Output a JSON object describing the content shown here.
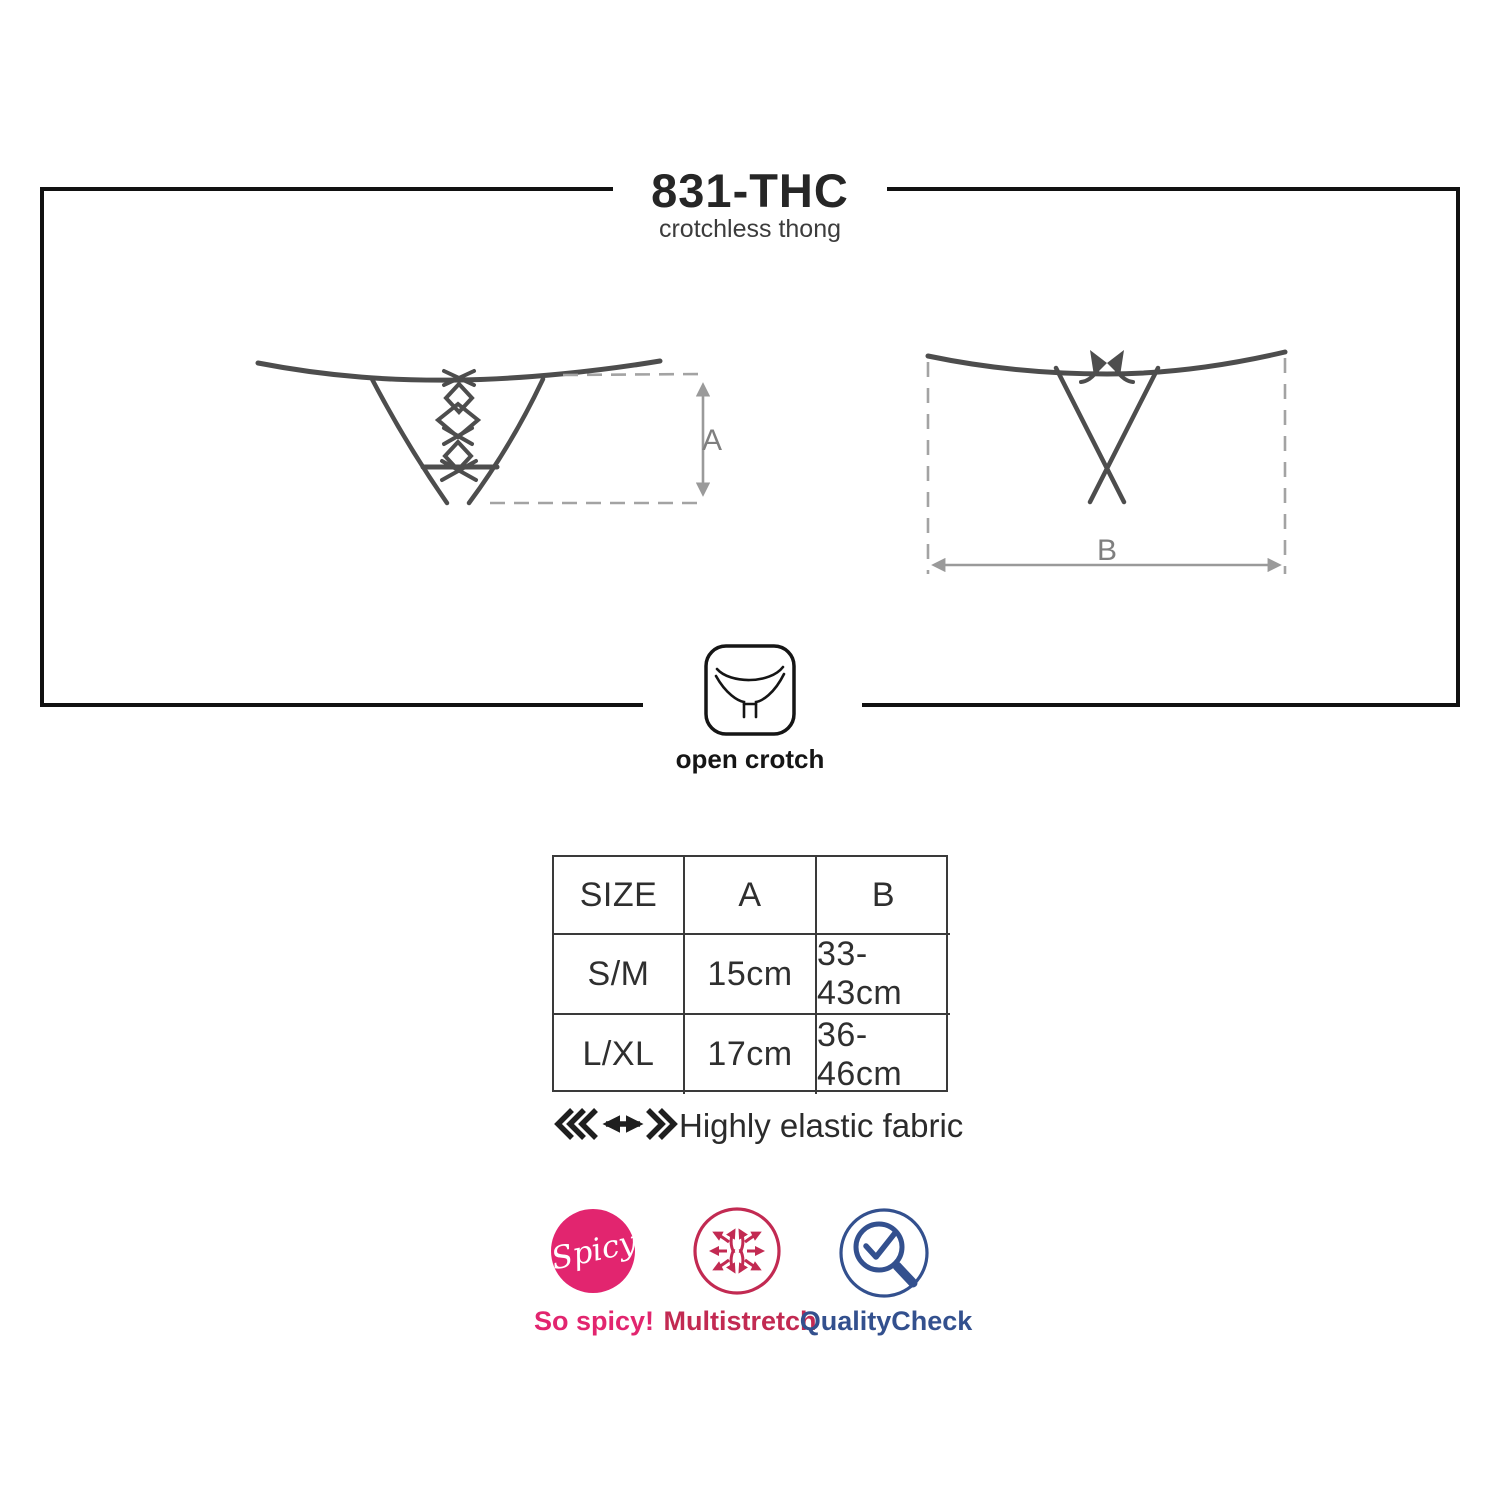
{
  "header": {
    "title": "831-THC",
    "subtitle": "crotchless thong"
  },
  "diagram": {
    "dimension_a_label": "A",
    "dimension_b_label": "B",
    "open_crotch_label": "open crotch"
  },
  "size_table": {
    "columns": [
      "SIZE",
      "A",
      "B"
    ],
    "rows": [
      [
        "S/M",
        "15cm",
        "33-43cm"
      ],
      [
        "L/XL",
        "17cm",
        "36-46cm"
      ]
    ]
  },
  "features": {
    "elastic_text": "Highly elastic fabric"
  },
  "badges": {
    "spicy": {
      "icon": "spicy-badge-icon",
      "circle_text": "Spicy",
      "label": "So spicy!",
      "color": "#e2256f"
    },
    "multistretch": {
      "icon": "multistretch-arrows-icon",
      "label": "Multistretch",
      "color": "#c22a52"
    },
    "quality": {
      "icon": "quality-check-magnifier-icon",
      "label": "QualityCheck",
      "color": "#33508e"
    }
  },
  "colors": {
    "frame_black": "#111111",
    "drawing_gray": "#4d4d4d",
    "dashed_gray": "#a3a3a3",
    "dimension_label_gray": "#7f7f7f",
    "pink": "#e2256f",
    "crimson": "#c22a52",
    "navy": "#33508e"
  }
}
